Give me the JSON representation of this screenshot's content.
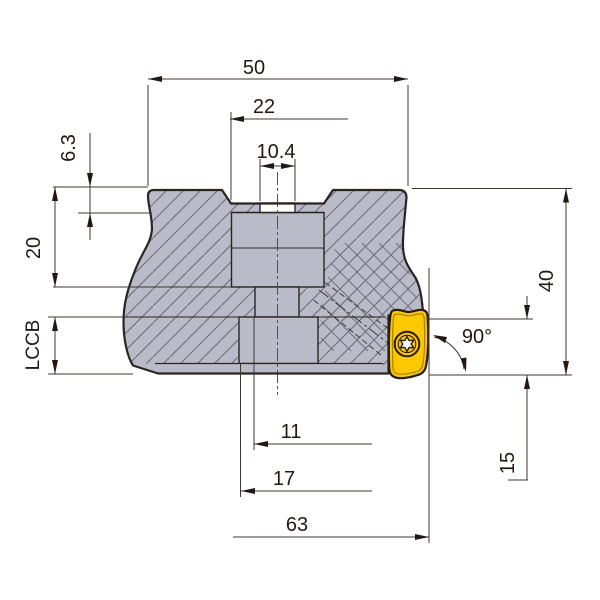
{
  "figure": {
    "description": "Cross-section dimension drawing of an indexable face milling cutter with one yellow insert",
    "colors": {
      "body_fill": "#b9bbc8",
      "outline": "#2b2520",
      "hatch_line": "#6a6a76",
      "dim_line": "#3f3832",
      "insert_yellow": "#fdc800",
      "insert_inner_line": "#a87f00",
      "screw_star": "#ffffff",
      "background": "#ffffff"
    },
    "dims": {
      "d50": "50",
      "d22": "22",
      "d10_4": "10.4",
      "d6_3": "6.3",
      "d20": "20",
      "dLCCB": "LCCB",
      "d40": "40",
      "d90": "90°",
      "d15": "15",
      "d11": "11",
      "d17": "17",
      "d63": "63"
    }
  }
}
